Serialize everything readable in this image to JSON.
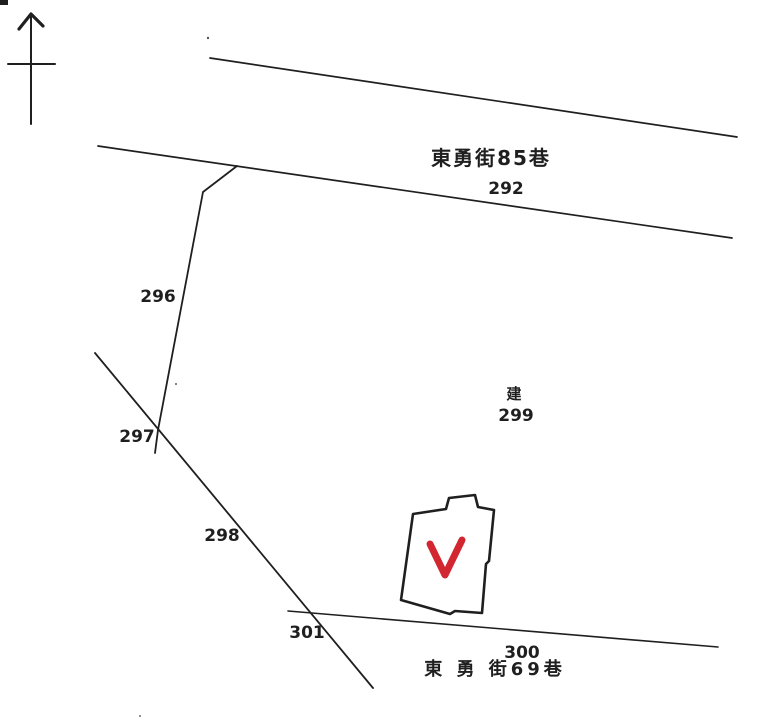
{
  "colors": {
    "ink": "#1f1f1f",
    "paper": "#ffffff",
    "check_red": "#d22630"
  },
  "compass": {
    "icon": "north-arrow"
  },
  "streets": {
    "top": {
      "name": "東勇街85巷",
      "road_parcel": "292"
    },
    "bottom": {
      "name": "東 勇 街69巷",
      "road_parcel": "300"
    }
  },
  "parcels": {
    "p296": "296",
    "p297": "297",
    "p298": "298",
    "p299": "299",
    "p301": "301"
  },
  "building": {
    "annotation": "建",
    "mark": "red-check"
  }
}
